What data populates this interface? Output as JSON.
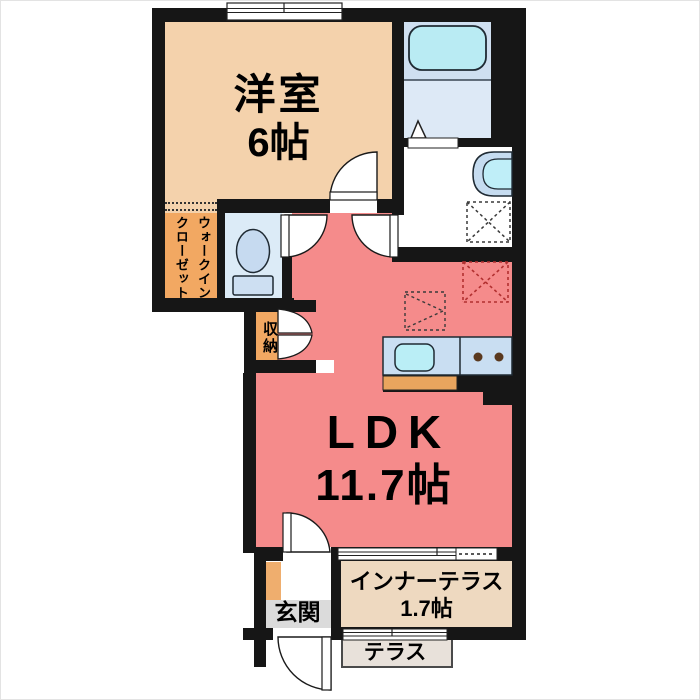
{
  "plan_type": "floorplan",
  "rooms": {
    "western_room": {
      "label": "洋室",
      "size": "6帖"
    },
    "walk_in_closet": {
      "label": "ウォークインクローゼット"
    },
    "storage": {
      "label": "収納"
    },
    "ldk": {
      "label": "LDK",
      "size": "11.7帖"
    },
    "entrance": {
      "label": "玄関"
    },
    "inner_terrace": {
      "label": "インナーテラス",
      "size": "1.7帖"
    },
    "terrace": {
      "label": "テラス"
    }
  },
  "fixtures": [
    "bathtub-icon",
    "bathroom-door-triangle",
    "washbasin-icon",
    "toilet-icon",
    "kitchen-sink-icon",
    "stove-burners-icon",
    "washing-machine-space",
    "refrigerator-space",
    "counter-space",
    "sliding-window",
    "door-swing-arc",
    "bifold-door",
    "entrance-door"
  ],
  "colors": {
    "wall": "#161616",
    "ldk_pink": "#f58b8b",
    "western_room_beige": "#f4d2ac",
    "closet_orange": "#f2a862",
    "shoebox_orange": "#efae6e",
    "wet_area_blue": "#dcebf7",
    "bathtub_cyan": "#b9ebf3",
    "kitchen_counter_blue": "#c9def2",
    "kitchen_base_orange": "#e9a55e",
    "entrance_gray": "#dbdbdb",
    "inner_terrace_beige": "#eed9c0",
    "terrace_gray": "#e8e1da",
    "refrigerator_dash_red": "#bb3333"
  }
}
